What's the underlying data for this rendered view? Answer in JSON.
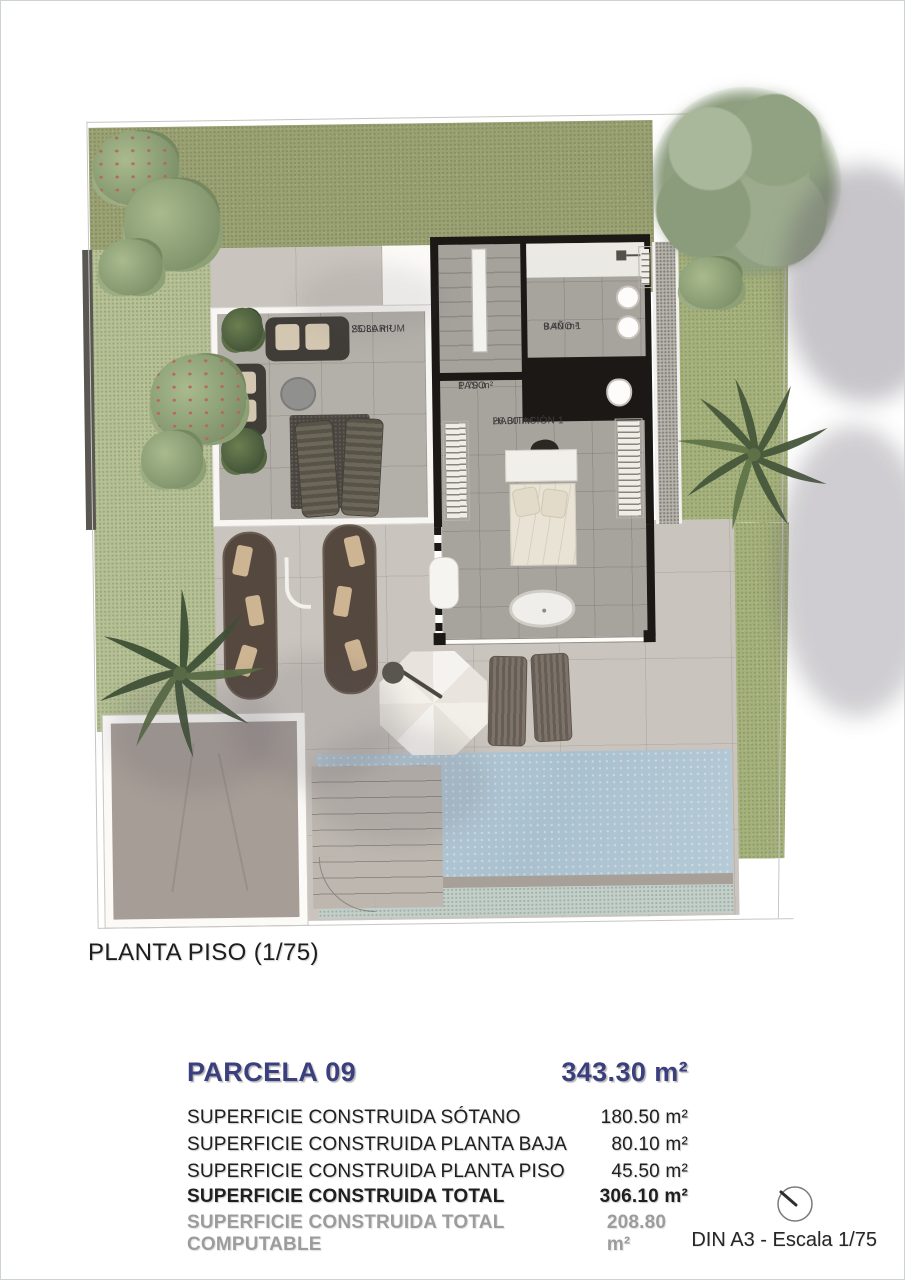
{
  "plan": {
    "caption": "PLANTA PISO (1/75)",
    "rooms": [
      {
        "name": "SOLARIUM",
        "area": "25.30 m²"
      },
      {
        "name": "BAÑO 1",
        "area": "9.40 m²"
      },
      {
        "name": "PASO",
        "area": "1.70 m²"
      },
      {
        "name": "HABITACIÓN 1",
        "area": "26.00 m²"
      }
    ],
    "colors": {
      "lawn": "#9aa172",
      "lawn_light": "#b5c094",
      "terrace": "#c9c4bd",
      "solarium_deck": "#b3afa9",
      "interior_floor": "#a7a39d",
      "wall": "#1b1816",
      "pool": "#aec4d2",
      "driveway": "#a69d96"
    }
  },
  "summary": {
    "parcel_label": "PARCELA 09",
    "parcel_area": "343.30 m²",
    "accent_color": "#3b3f7d",
    "rows": [
      {
        "label": "SUPERFICIE CONSTRUIDA SÓTANO",
        "value": "180.50 m²"
      },
      {
        "label": "SUPERFICIE CONSTRUIDA PLANTA BAJA",
        "value": "80.10 m²"
      },
      {
        "label": "SUPERFICIE CONSTRUIDA PLANTA PISO",
        "value": "45.50 m²"
      },
      {
        "label": "SUPERFICIE CONSTRUIDA TOTAL",
        "value": "306.10 m²"
      },
      {
        "label": "SUPERFICIE CONSTRUIDA TOTAL COMPUTABLE",
        "value": "208.80 m²"
      }
    ]
  },
  "footer": {
    "scale_note": "DIN A3 - Escala 1/75",
    "icons": {
      "north": "compass-north-icon"
    }
  }
}
